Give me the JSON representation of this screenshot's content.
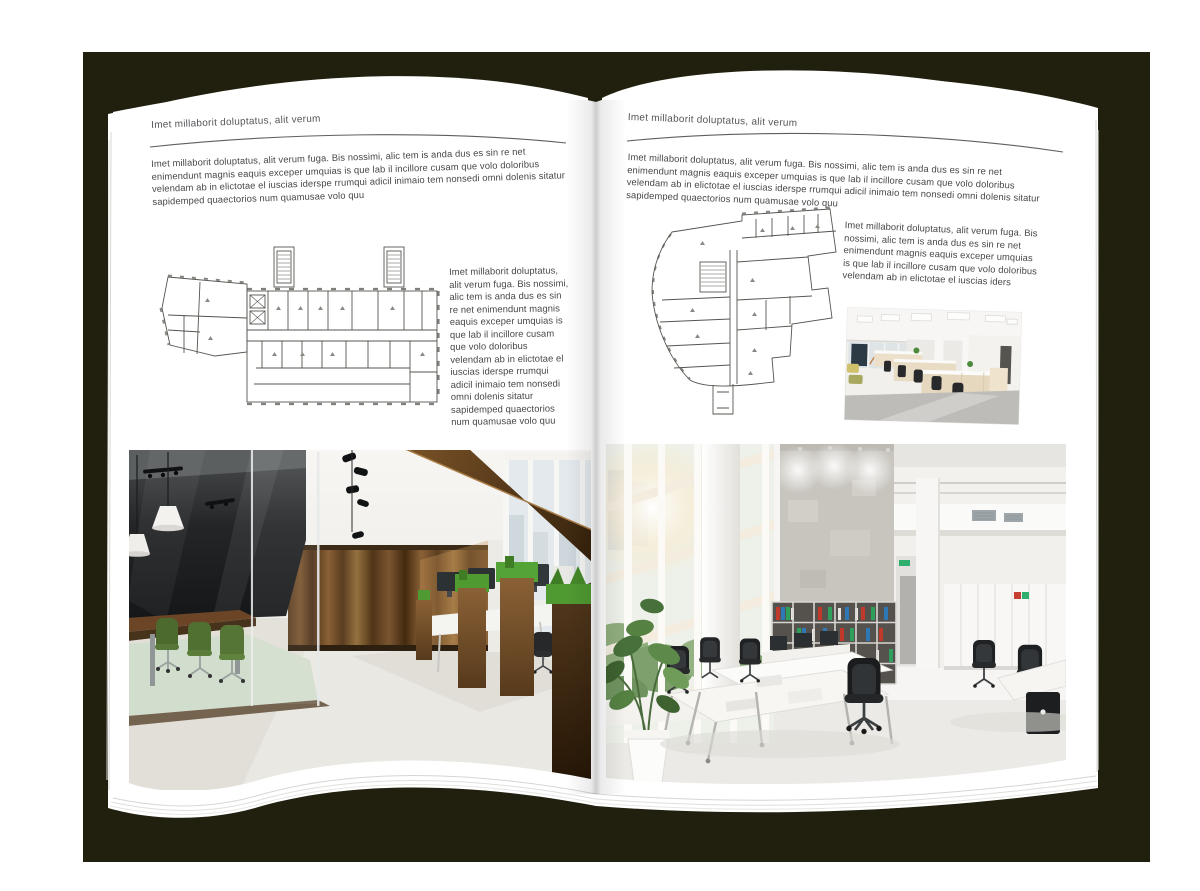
{
  "book": {
    "backdrop_color": "#21200f",
    "page_color": "#ffffff",
    "plan_line_color": "#54544f"
  },
  "left_page": {
    "header": "Imet millaborit doluptatus, alit verum",
    "intro": "Imet millaborit doluptatus, alit verum fuga. Bis nossimi, alic tem is anda dus es sin re net enimendunt magnis eaquis exceper umquias is que lab il incillore cusam que volo doloribus velendam ab in elictotae el iuscias iderspe rrumqui adicil inimaio tem nonsedi omni dolenis sitatur sapidemped quaectorios num quamusae volo quu",
    "side_text": "Imet millaborit doluptatus, alit verum fuga. Bis nossimi, alic tem is anda dus es sin re net enimendunt magnis eaquis exceper umquias is que lab il incillore cusam que volo doloribus velendam ab in elictotae el iuscias iderspe rrumqui adicil inimaio tem nonsedi omni dolenis sitatur sapidemped quaectorios num quamusae volo quu"
  },
  "right_page": {
    "header": "Imet millaborit doluptatus, alit verum",
    "intro": "Imet millaborit doluptatus, alit verum fuga. Bis nossimi, alic tem is anda dus es sin re net enimendunt magnis eaquis exceper umquias is que lab il incillore cusam que volo doloribus velendam ab in elictotae el iuscias iderspe rrumqui adicil inimaio tem nonsedi omni dolenis sitatur sapidemped quaectorios num quamusae volo quu",
    "side_text": "Imet millaborit doluptatus, alit verum fuga. Bis nossimi, alic tem is anda dus es sin re net enimendunt magnis eaquis exceper umquias is que lab il incillore cusam que volo doloribus velendam ab in elictotae el iuscias iders"
  },
  "images": {
    "left_floor_plan": "architectural-floor-plan",
    "right_floor_plan": "architectural-floor-plan",
    "left_photo": "office-interior-wood-and-glass",
    "right_photo": "office-interior-white-loft",
    "right_small_photo": "open-plan-office"
  }
}
